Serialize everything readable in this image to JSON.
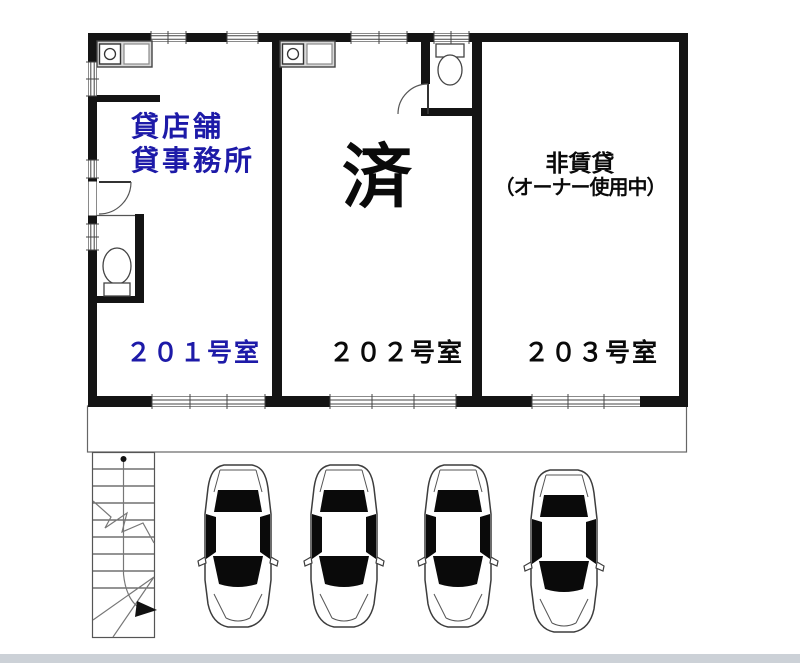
{
  "floorplan": {
    "building": {
      "units": [
        {
          "room_label": "２０１号室",
          "status_line1": "貸店舗",
          "status_line2": "貸事務所",
          "status_color": "#1d1aa8"
        },
        {
          "room_label": "２０２号室",
          "status": "済",
          "status_color": "#0a0a0a"
        },
        {
          "room_label": "２０３号室",
          "status_line1": "非賃貸",
          "status_line2": "（オーナー使用中）",
          "status_color": "#0a0a0a"
        }
      ]
    },
    "site": {
      "parking_car_count": 4,
      "icons": [
        "staircase-icon",
        "car-icon",
        "toilet-icon",
        "kitchen-sink-icon",
        "door-swing-icon",
        "window-icon"
      ]
    },
    "colors": {
      "walls": "#141414",
      "vacant_text": "#1d1aa8",
      "line": "#555555",
      "background": "#ffffff",
      "footer_bar": "#ccd1d7"
    }
  }
}
